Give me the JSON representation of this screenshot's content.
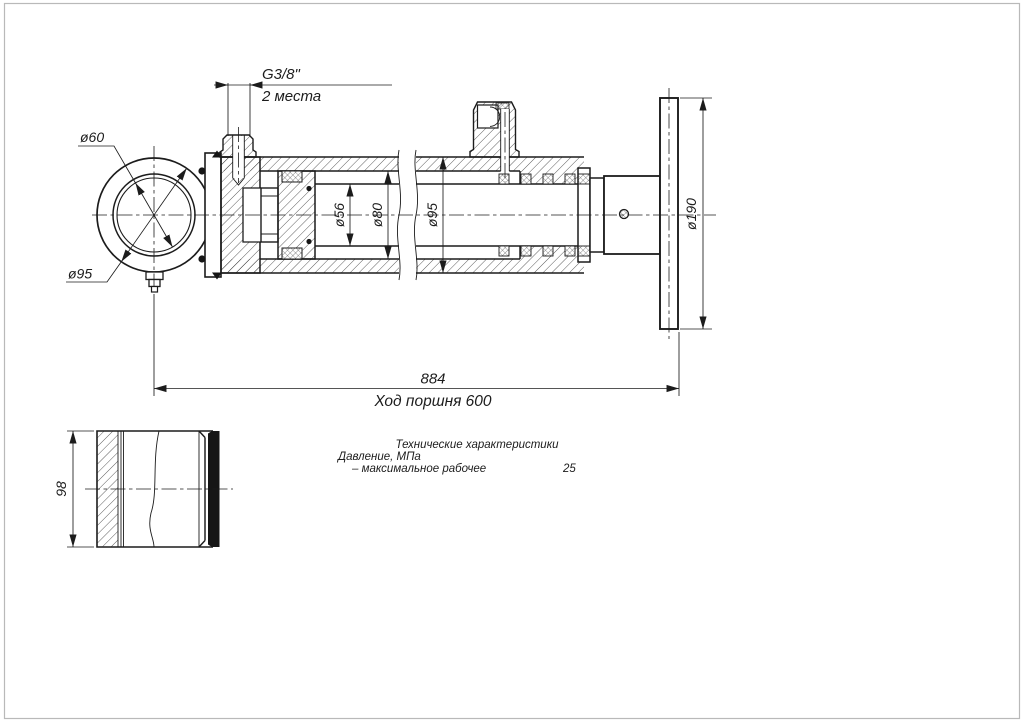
{
  "drawing": {
    "colors": {
      "ink": "#1c1c1c",
      "paper": "#ffffff",
      "frame": "#b9b9b9"
    },
    "dims": {
      "port_thread": "G3/8\"",
      "port_places": "2 места",
      "eye_bore": "ø60",
      "eye_outer": "ø95",
      "rod_diameter": "ø56",
      "bore_diameter": "ø80",
      "barrel_diameter": "ø95",
      "flange_diameter": "ø190",
      "overall_length": "884",
      "piston_stroke": "Ход поршня 600",
      "sleeve_width": "98"
    },
    "specs": {
      "title": "Технические характеристики",
      "pressure_group_label": "Давление, МПа",
      "max_working_label": "– максимальное рабочее",
      "max_working_value": "25"
    }
  }
}
